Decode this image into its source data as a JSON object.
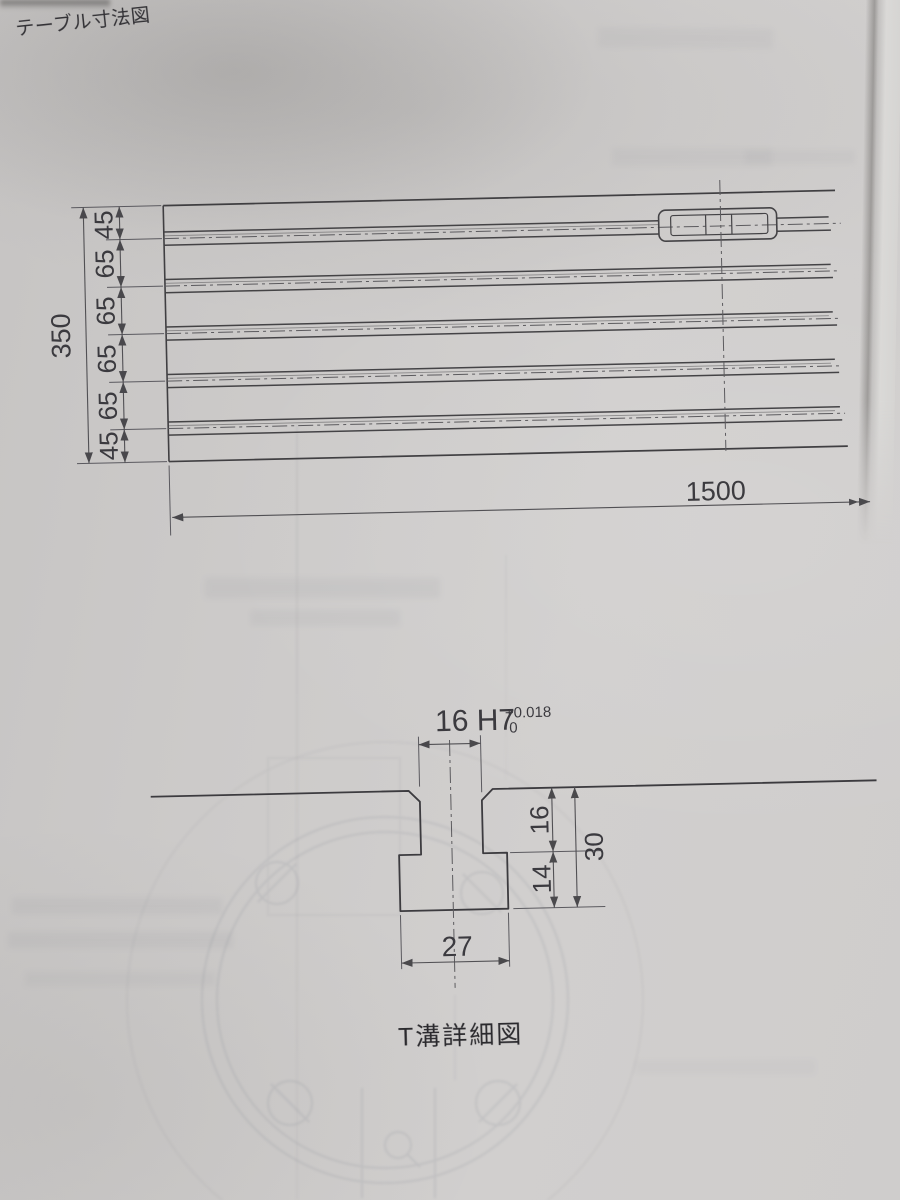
{
  "title": "テーブル寸法図",
  "table_view": {
    "total_height": "350",
    "height_segments": [
      "45",
      "65",
      "65",
      "65",
      "65",
      "45"
    ],
    "length": "1500"
  },
  "t_slot_detail": {
    "caption": "T溝詳細図",
    "slot_width": "16 H7",
    "tolerance_upper": "+0.018",
    "tolerance_lower": "0",
    "throat_depth": "16",
    "undercut_depth": "14",
    "total_depth": "30",
    "base_width": "27"
  },
  "colors": {
    "ink": "#39383b",
    "paper": "#cbc9c8"
  }
}
